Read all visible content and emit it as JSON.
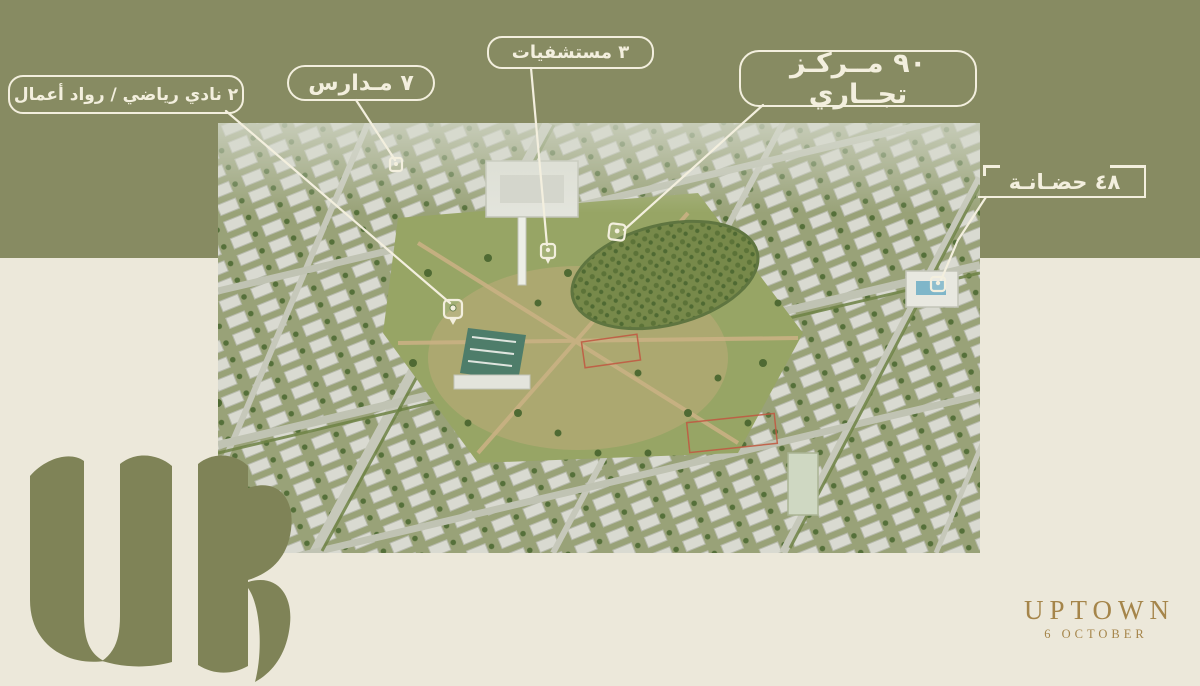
{
  "page": {
    "background_color": "#ece8da",
    "band_color": "#878b62",
    "annotation_color": "#f3efde"
  },
  "annotations": {
    "sports_club": "٢ نادي رياضي / رواد أعمال",
    "schools": "٧ مـدارس",
    "hospitals": "٣ مستشفيات",
    "commercial": "٩٠ مــركـز تجــاري",
    "nursery": "٤٨ حضـانـة"
  },
  "branding": {
    "monogram": "UR",
    "name": "UPTOWN",
    "subname": "6 OCTOBER",
    "gold_color": "#a5854a",
    "olive_color": "#7f8357"
  },
  "image": {
    "description": "aerial-masterplan-render"
  }
}
